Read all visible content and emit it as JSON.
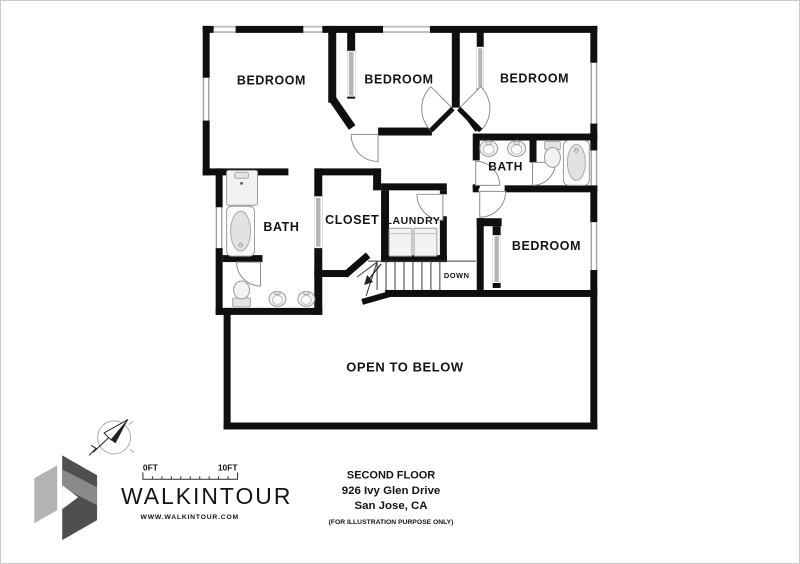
{
  "plan": {
    "rooms": [
      {
        "name": "bedroom-top-left",
        "label": "BEDROOM"
      },
      {
        "name": "bedroom-top-middle",
        "label": "BEDROOM"
      },
      {
        "name": "bedroom-top-right",
        "label": "BEDROOM"
      },
      {
        "name": "bath-upper-right",
        "label": "BATH"
      },
      {
        "name": "bedroom-right",
        "label": "BEDROOM"
      },
      {
        "name": "bath-left",
        "label": "BATH"
      },
      {
        "name": "closet",
        "label": "CLOSET"
      },
      {
        "name": "laundry",
        "label": "LAUNDRY"
      },
      {
        "name": "open-to-below",
        "label": "OPEN TO BELOW"
      }
    ],
    "stairs_label": "DOWN"
  },
  "scale_bar": {
    "start": "0FT",
    "end": "10FT"
  },
  "branding": {
    "name": "WALKINTOUR",
    "website": "WWW.WALKINTOUR.COM"
  },
  "title_block": {
    "floor": "SECOND FLOOR",
    "address": "926 Ivy Glen Drive",
    "city": "San Jose, CA",
    "disclaimer": "(FOR ILLUSTRATION PURPOSE ONLY)"
  },
  "colors": {
    "wall": "#0f0f0f",
    "fixture_stroke": "#9a9a9a",
    "accent_gray": "#9b9b9b"
  }
}
